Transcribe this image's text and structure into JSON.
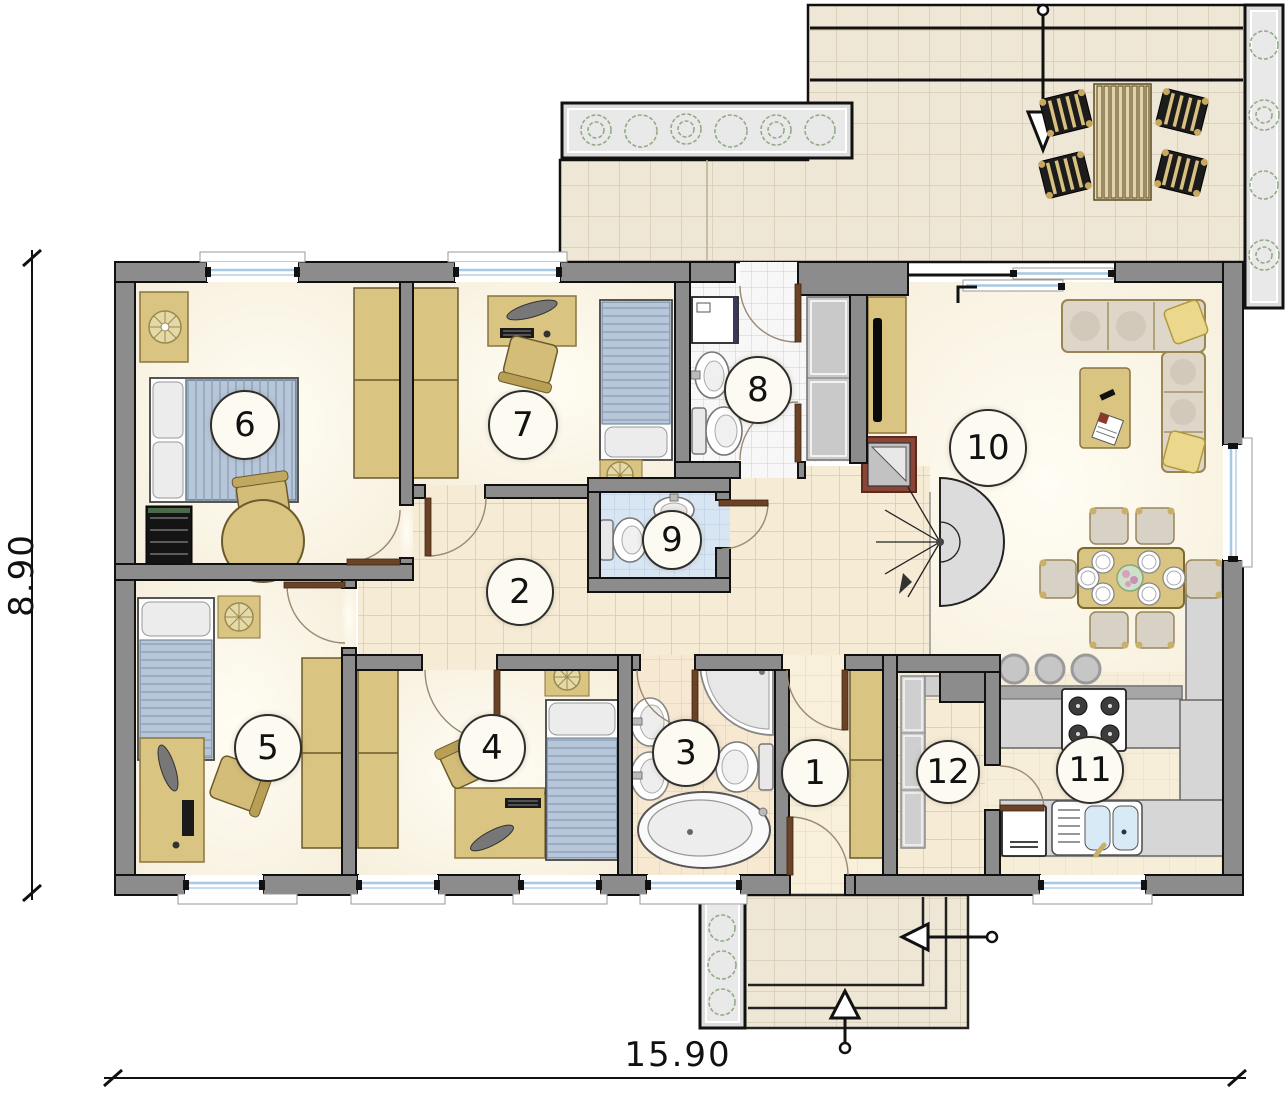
{
  "plan": {
    "dimensions": {
      "width_label": "15.90",
      "height_label": "8.90"
    },
    "rooms": [
      {
        "number": "1"
      },
      {
        "number": "2"
      },
      {
        "number": "3"
      },
      {
        "number": "4"
      },
      {
        "number": "5"
      },
      {
        "number": "6"
      },
      {
        "number": "7"
      },
      {
        "number": "8"
      },
      {
        "number": "9"
      },
      {
        "number": "10"
      },
      {
        "number": "11"
      },
      {
        "number": "12"
      }
    ]
  }
}
